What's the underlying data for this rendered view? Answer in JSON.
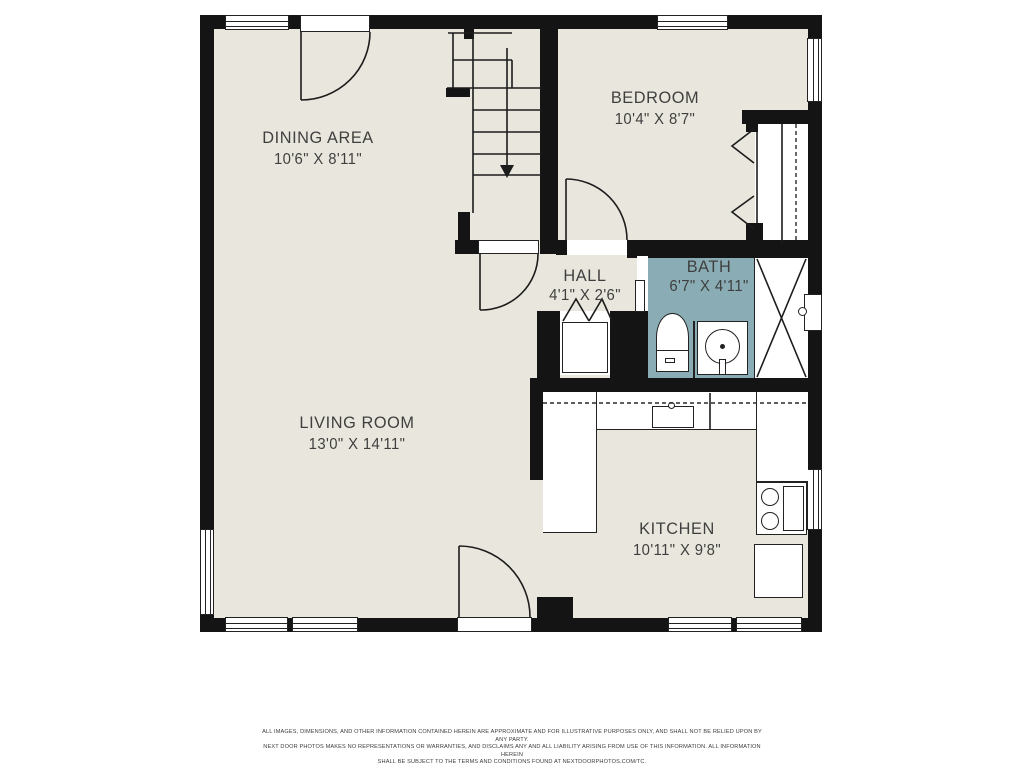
{
  "rooms": [
    {
      "name": "DINING AREA",
      "dims": "10'6\" X 8'11\""
    },
    {
      "name": "BEDROOM",
      "dims": "10'4\" X 8'7\""
    },
    {
      "name": "HALL",
      "dims": "4'1\" X 2'6\""
    },
    {
      "name": "BATH",
      "dims": "6'7\" X 4'11\""
    },
    {
      "name": "LIVING ROOM",
      "dims": "13'0\" X 14'11\""
    },
    {
      "name": "KITCHEN",
      "dims": "10'11\" X 9'8\""
    }
  ],
  "icons": {
    "stairs_direction": "down-arrow",
    "shower": "x-cross",
    "closet_doors": "bifold-chevrons",
    "closet_rod": "dashed-line"
  },
  "disclaimer": {
    "line1": "ALL IMAGES, DIMENSIONS, AND OTHER INFORMATION CONTAINED HEREIN ARE APPROXIMATE AND FOR ILLUSTRATIVE PURPOSES ONLY, AND SHALL NOT BE RELIED UPON BY ANY PARTY.",
    "line2": "NEXT DOOR PHOTOS MAKES NO REPRESENTATIONS OR WARRANTIES, AND DISCLAIMS ANY AND ALL LIABILITY ARISING FROM USE OF THIS INFORMATION. ALL INFORMATION HEREIN",
    "line3": "SHALL BE SUBJECT TO THE TERMS AND CONDITIONS FOUND AT NEXTDOORPHOTOS.COM/TC."
  },
  "colors": {
    "floor": "#e9e7dd",
    "wall": "#141414",
    "bath_fill": "#8aacb4",
    "line": "#222222",
    "text": "#3f3f3f",
    "background": "#ffffff"
  }
}
